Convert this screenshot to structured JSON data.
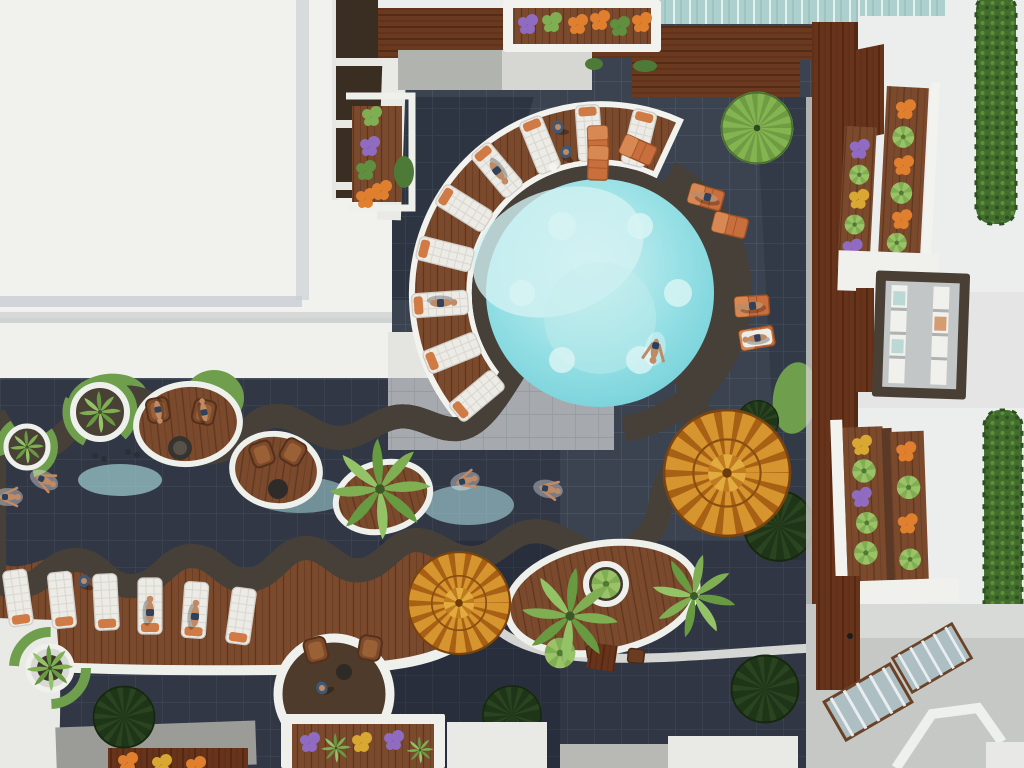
{
  "meta": {
    "type": "3d-architectural-render",
    "view": "top-down aerial",
    "subject": "Resort courtyard with freeform lazy-river pool and circular lagoon",
    "width_px": 1024,
    "height_px": 768
  },
  "scene": {
    "setting": "Sunny daylight aerial view of a hotel courtyard: turquoise freeform pool with scalloped white coping winds between charcoal tile decks, timber sun decks and white apartment buildings with flower-filled balconies",
    "pool": {
      "label": "Lazy-river pool with circular lagoon",
      "water": "bright turquoise with pale shallow shelves",
      "lagoon_submerged_discs": 6,
      "edge": "white scalloped coping with dark stone wet-edge trim"
    },
    "furniture": {
      "white_quilted_loungers": 15,
      "orange_slat_loungers": 7,
      "wicker_chairs": 6,
      "round_parasols": 2,
      "fire_pit": 1
    },
    "vegetation": {
      "palm_trees": 5,
      "potted_palms": 4,
      "round_boxwood_bushes": 5,
      "fan_tree": 1,
      "hedge_walls": 2,
      "flower_colors": [
        "orange",
        "purple",
        "yellow",
        "green"
      ]
    },
    "buildings": {
      "left": "large white roof block with dark window band and flower balcony",
      "top_right": "white facade, balcony with vertical flower planters, green hedge",
      "right": "picture window with dark timber frame, lower balcony planters",
      "walkway": "L-shaped elevated mahogany boardwalk",
      "bottom_right": "terrace with glazed skylight stairs and timber door"
    },
    "people_total": 16,
    "people_activities": [
      "swimming",
      "sunbathing on loungers",
      "standing on deck",
      "walking",
      "sitting at pool edge"
    ]
  },
  "colors": {
    "tile": "#3b4250",
    "tileGrout": "#4a5461",
    "tileLight": "#a6aaae",
    "tileLightGrout": "#93989d",
    "shadow": "#0e1320",
    "wood": "#7b4a2d",
    "woodLine": "#5e3620",
    "walkway": "#67331a",
    "coping": "#f0f1ec",
    "white": "#ededeb",
    "roof": "#f1f1ee",
    "water": "#82d6dd",
    "waterShallow": "#d3f2f2",
    "waterDeep": "#6ccbd6",
    "stoneTrim": "#474039",
    "grass": "#6f9e4d",
    "grassDark": "#4e7a38",
    "bush": "#2a4321",
    "amber": "#d6952f",
    "amberDark": "#a86015",
    "loungerOrange": "#c96f3e",
    "loungerPad": "#d07b45",
    "quilt": "#ecebe6",
    "wicker": "#7d4b2c",
    "hedge": "#426d2c",
    "glass": "#abd0cd",
    "frame": "#4a3f35",
    "terrace": "#c6c8c6",
    "concrete": "#9b9b97",
    "slab": "#b0b3ae",
    "skin": "#c08a64",
    "flowerOrange": "#e0802f",
    "flowerPurple": "#8f6cc2",
    "flowerYellow": "#d9a832",
    "foliage": "#679a41"
  }
}
